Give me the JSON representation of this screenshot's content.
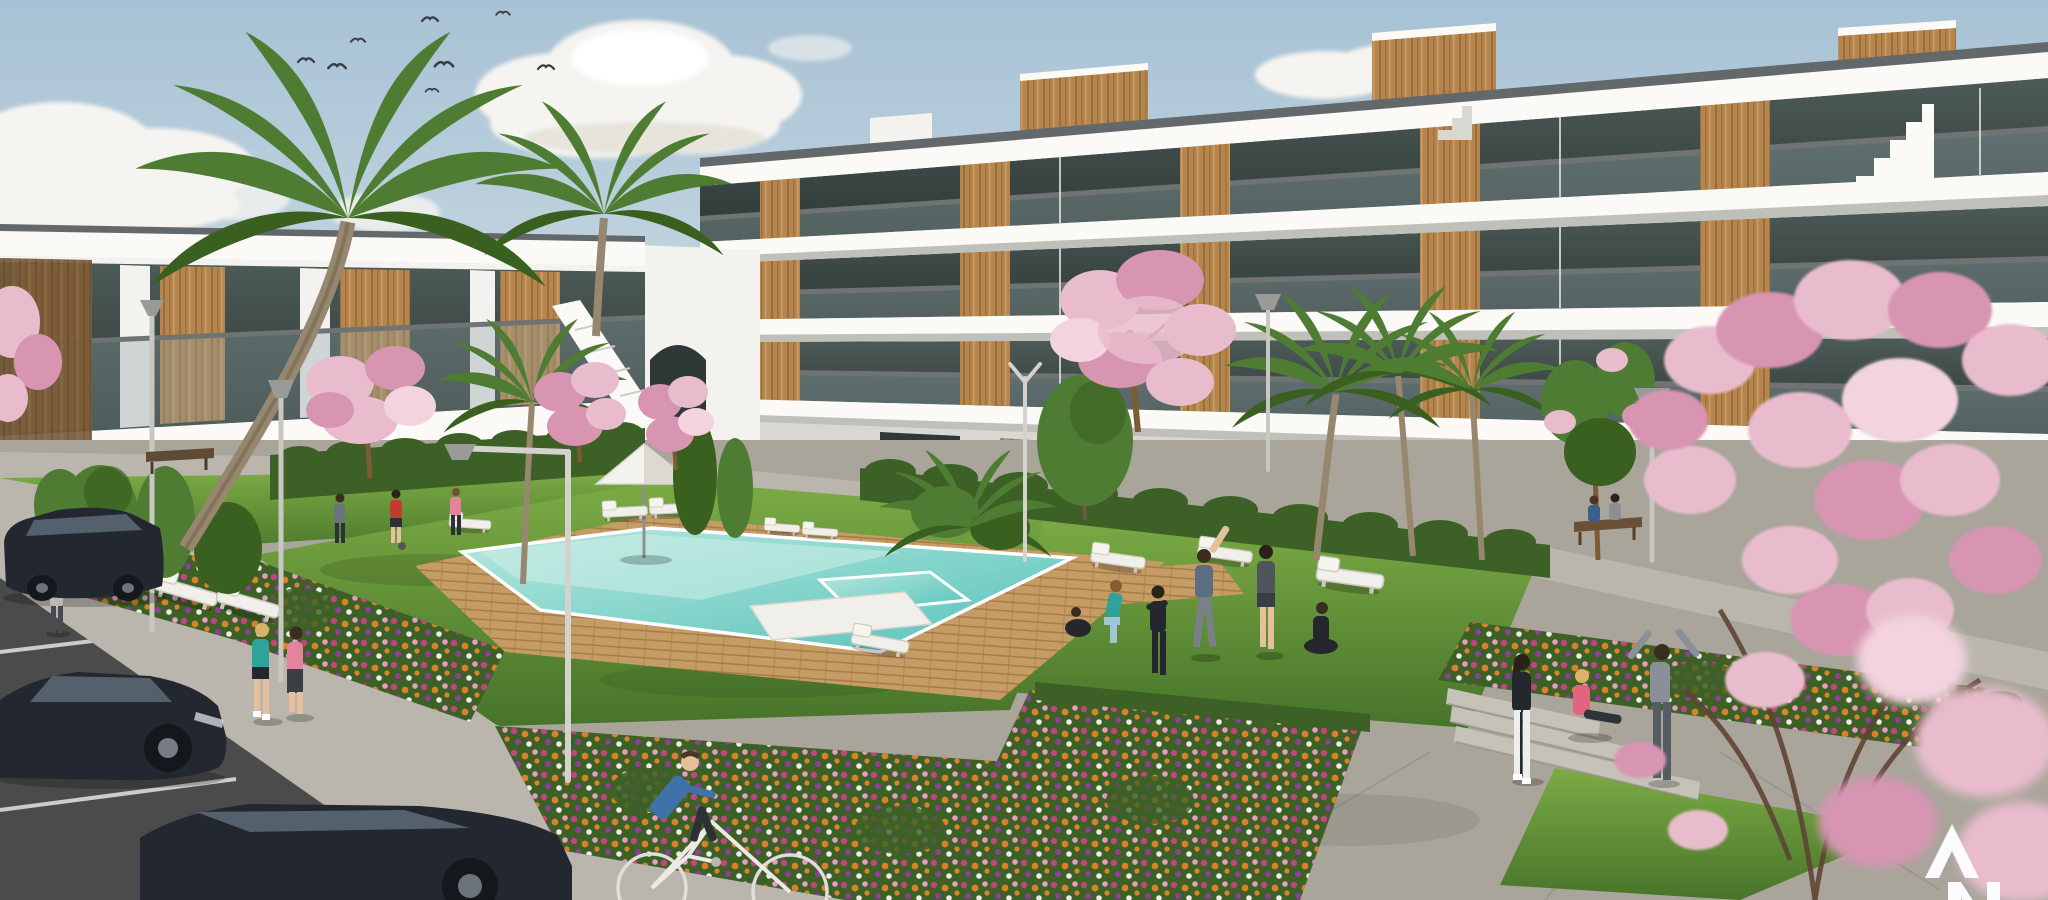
{
  "watermark": {
    "text": "AN",
    "letter_top": "A",
    "letter_bottom": "N",
    "color": "#ffffff",
    "position": "bottom-right",
    "cropped": "bottom letter cut by image edge"
  },
  "palette": {
    "sky_top": "#a7c2d5",
    "sky_low": "#dde6e9",
    "cloud": "#f6f4f0",
    "cloud_shade": "#ddd8cf",
    "bldg_white": "#f3f2ee",
    "bldg_bright": "#fbfaf7",
    "bldg_shade": "#d9d7d1",
    "slab_under": "#8f8f8b",
    "glass_dark": "#2e3836",
    "glass_mid": "#4c5a58",
    "glass_hi": "#8da1a3",
    "wood": "#b5854c",
    "wood_dark": "#7e5c33",
    "lawn_hi": "#7cab45",
    "lawn_lo": "#47742a",
    "hedge": "#3c6026",
    "pool_hi": "#b7e8df",
    "pool_lo": "#55c2b9",
    "deck": "#c59c64",
    "deck_line": "#a57c49",
    "path": "#bab6ad",
    "plaza": "#a9a59b",
    "step": "#c6c2b8",
    "asphalt": "#4b4b4b",
    "line": "#e6e6e3",
    "car": "#232830",
    "car_glass": "#54606c",
    "blossom": "#e9bccd",
    "blossom_deep": "#d795b2",
    "blossom_pale": "#f2d3de",
    "palm": "#4e7c33",
    "palm_dark": "#39601f",
    "trunk": "#97876e",
    "flower_magenta": "#c2457f",
    "flower_orange": "#d9822b",
    "flower_pink": "#e79cc0",
    "flower_purple": "#8e3f98",
    "flower_white": "#efe9e9",
    "skin": "#e6c09c",
    "teal": "#2fa39a",
    "red_shirt": "#c23b30",
    "pink_shirt": "#e6839c",
    "blue_shirt": "#3f72a8",
    "gray_cloth": "#6d737b",
    "dark_cloth": "#24282e",
    "light_legging": "#9fc6d8",
    "white_cloth": "#eeeeee"
  },
  "scene": {
    "setting": "Sunlit 3D architectural rendering of a modern white apartment complex with wood accents, communal lawn, swimming pool, flower beds, palm and blossom trees, parking lot and residents exercising",
    "sky": {
      "birds": 8,
      "cloud_clusters": 5
    },
    "buildings": {
      "left_floors": 2,
      "right_floors": 4,
      "style": "white contemporary blocks, glass balconies, vertical wood panelling, rooftop wood volumes"
    },
    "pool": {
      "shape": "rectangular with spa section and white platform",
      "deck": "wood",
      "parasols": 1,
      "sun_loungers": 11
    },
    "people": {
      "total": 18,
      "groups": [
        "walker",
        "three playing ball on lawn",
        "two joggers",
        "exercise group of six",
        "stretching trio",
        "couple on bench",
        "cyclist"
      ]
    },
    "vehicles": {
      "parked_cars": 3,
      "bicycles": 1
    },
    "vegetation": {
      "palm_trees": 7,
      "blossom_trees": 7,
      "flower_beds": 4,
      "street_lamps": 6,
      "benches": 2
    }
  }
}
